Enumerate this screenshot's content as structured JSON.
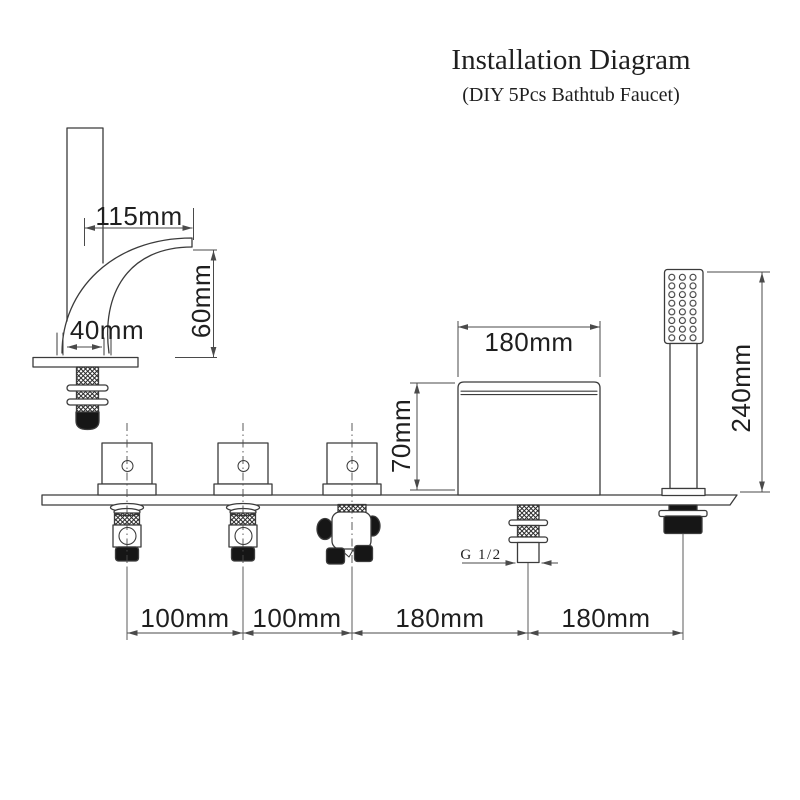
{
  "header": {
    "title": "Installation Diagram",
    "subtitle": "(DIY 5Pcs Bathtub Faucet)"
  },
  "labels": {
    "spout_reach": "115mm",
    "spout_height": "60mm",
    "spout_base_width": "40mm",
    "body_width": "180mm",
    "body_height": "70mm",
    "shower_height": "240mm",
    "thread_size": "G 1/2",
    "spacing_1": "100mm",
    "spacing_2": "100mm",
    "spacing_3": "180mm",
    "spacing_4": "180mm"
  },
  "colors": {
    "background": "#ffffff",
    "outline": "#3b3b3b",
    "dimension": "#4a4a4a",
    "text": "#1f1f1f",
    "dark_fill": "#161616"
  }
}
